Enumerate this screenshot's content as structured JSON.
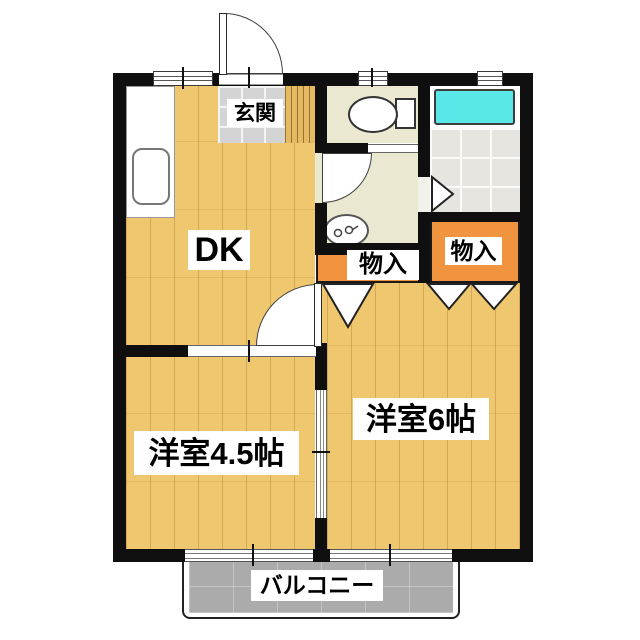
{
  "floorplan": {
    "type": "apartment-floor-plan",
    "labels": {
      "genkan": "玄関",
      "dk": "DK",
      "closet_hall": "物入",
      "closet_bedroom": "物入",
      "western_6": "洋室6帖",
      "western_45": "洋室4.5帖",
      "balcony": "バルコニー"
    },
    "fixtures": {
      "kitchen_counter": "kitchen-counter-with-sink",
      "toilet": "toilet-with-tank",
      "bathtub": "bathtub",
      "washbasin": "washbasin"
    },
    "colors": {
      "wall": "#0f0f0f",
      "wood_floor": "#eec76f",
      "entrance_tile": "#d4d4d4",
      "wet_area_floor": "#eae8d0",
      "bath_tile": "#e6e5df",
      "bathtub": "#59e7e7",
      "closet": "#f09440",
      "balcony": "#ababab"
    }
  }
}
